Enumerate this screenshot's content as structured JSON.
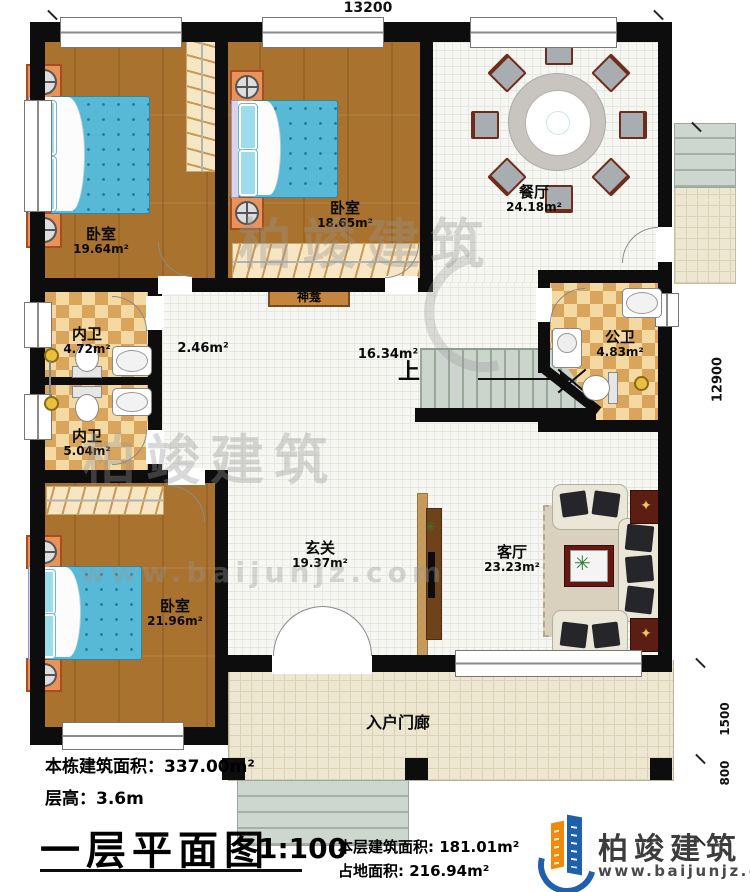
{
  "dims": {
    "top": "13200",
    "right": "12900",
    "lower_right_1": "1500",
    "lower_right_2": "800"
  },
  "rooms": {
    "bedroom1": {
      "name": "卧室",
      "area": "19.64m²"
    },
    "bedroom2": {
      "name": "卧室",
      "area": "18.65m²"
    },
    "bedroom3": {
      "name": "卧室",
      "area": "21.96m²"
    },
    "dining": {
      "name": "餐厅",
      "area": "24.18m²"
    },
    "bath1": {
      "name": "内卫",
      "area": "4.72m²"
    },
    "bath2": {
      "name": "内卫",
      "area": "5.04m²"
    },
    "pubbath": {
      "name": "公卫",
      "area": "4.83m²"
    },
    "corridor": {
      "area": "2.46m²"
    },
    "hall": {
      "area": "16.34m²"
    },
    "shrine": {
      "name": "神龛"
    },
    "stairs": {
      "up": "上"
    },
    "foyer": {
      "name": "玄关",
      "area": "19.37m²"
    },
    "living": {
      "name": "客厅",
      "area": "23.23m²"
    },
    "porch": {
      "name": "入户门廊"
    }
  },
  "titleblock": {
    "building_area": "本栋建筑面积：337.00m²",
    "floor_height": "层高：3.6m",
    "title": "一层平面图",
    "scale": "1:100",
    "floor_area": "本层建筑面积: 181.01m²",
    "footprint": "占地面积: 216.94m²"
  },
  "brand": {
    "name": "柏竣建筑",
    "url": "www.baijunjz.com"
  },
  "watermark": {
    "name": "柏竣建筑",
    "url": "www.baijunjz.com"
  },
  "icons": {
    "plant": "✳",
    "star": "✦"
  },
  "colors": {
    "wall": "#0d0d0d",
    "wood": "#a9722e",
    "checker": "#d9a55c",
    "bed": "#58b9d6",
    "logo_blue": "#1e5fae",
    "logo_orange": "#f08a0c"
  }
}
